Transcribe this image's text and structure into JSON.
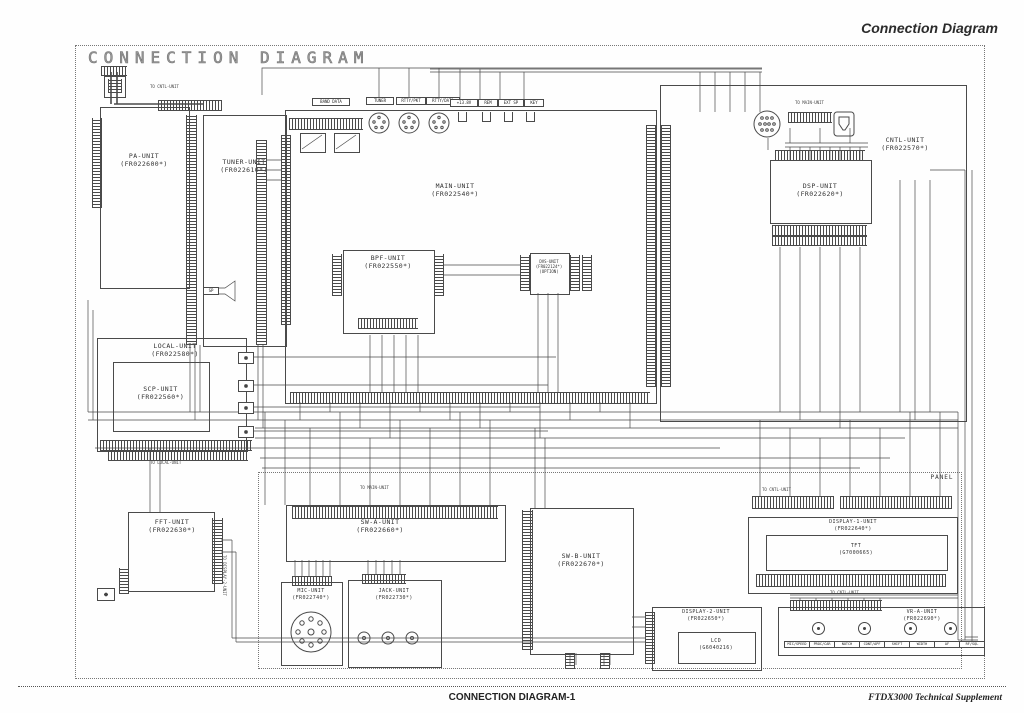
{
  "page": {
    "title": "CONNECTION DIAGRAM",
    "header_right": "Connection Diagram",
    "footer_center": "CONNECTION DIAGRAM-1",
    "footer_right": "FTDX3000 Technical Supplement",
    "panel_label": "PANEL"
  },
  "units": {
    "pa": {
      "name": "PA-UNIT",
      "part": "(FR022600*)"
    },
    "tuner": {
      "name": "TUNER-UNIT",
      "part": "(FR022610*)"
    },
    "main": {
      "name": "MAIN-UNIT",
      "part": "(FR022540*)"
    },
    "bpf": {
      "name": "BPF-UNIT",
      "part": "(FR022550*)"
    },
    "dvs": {
      "name": "DVS-UNIT",
      "part": "(FR022124*)",
      "note": "(OPTION)"
    },
    "cntl": {
      "name": "CNTL-UNIT",
      "part": "(FR022570*)"
    },
    "dsp": {
      "name": "DSP-UNIT",
      "part": "(FR022620*)"
    },
    "local": {
      "name": "LOCAL-UNIT",
      "part": "(FR022580*)"
    },
    "scp": {
      "name": "SCP-UNIT",
      "part": "(FR022560*)"
    },
    "fft": {
      "name": "FFT-UNIT",
      "part": "(FR022630*)"
    },
    "swa": {
      "name": "SW-A-UNIT",
      "part": "(FR022660*)"
    },
    "swb": {
      "name": "SW-B-UNIT",
      "part": "(FR022670*)"
    },
    "mic": {
      "name": "MIC-UNIT",
      "part": "(FR022740*)"
    },
    "jack": {
      "name": "JACK-UNIT",
      "part": "(FR022730*)"
    },
    "display1": {
      "name": "DISPLAY-1-UNIT",
      "part": "(FR022640*)"
    },
    "tft": {
      "name": "TFT",
      "part": "(G7000665)"
    },
    "display2": {
      "name": "DISPLAY-2-UNIT",
      "part": "(FR022650*)"
    },
    "lcd": {
      "name": "LCD",
      "part": "(G6040216)"
    },
    "vra": {
      "name": "VR-A-UNIT",
      "part": "(FR022690*)"
    }
  },
  "connectors": {
    "band_data": "BAND DATA",
    "din1": "TUNER",
    "din2": "RTTY/PKT",
    "din3": "RTTY/DATA",
    "jack1": "+13.8V",
    "jack2": "REM",
    "jack3": "EXT SP",
    "jack4": "KEY",
    "sp": "SP"
  },
  "vr_controls": [
    "MIC/SPEED",
    "PROC/CAR",
    "NOTCH",
    "CONT/APF",
    "SHIFT",
    "WIDTH",
    "AF",
    "RF/SQL"
  ],
  "callouts": {
    "c1": "TO CNTL-UNIT",
    "c2": "TO MAIN-UNIT",
    "c3": "TO MAIN-UNIT",
    "c4": "TO CNTL-UNIT",
    "c5": "TO CNTL-UNIT",
    "c6": "TO DISPLAY-2-UNIT",
    "c7": "TO LOCAL-UNIT"
  },
  "colors": {
    "line": "#4a4a4a",
    "text": "#333333"
  }
}
